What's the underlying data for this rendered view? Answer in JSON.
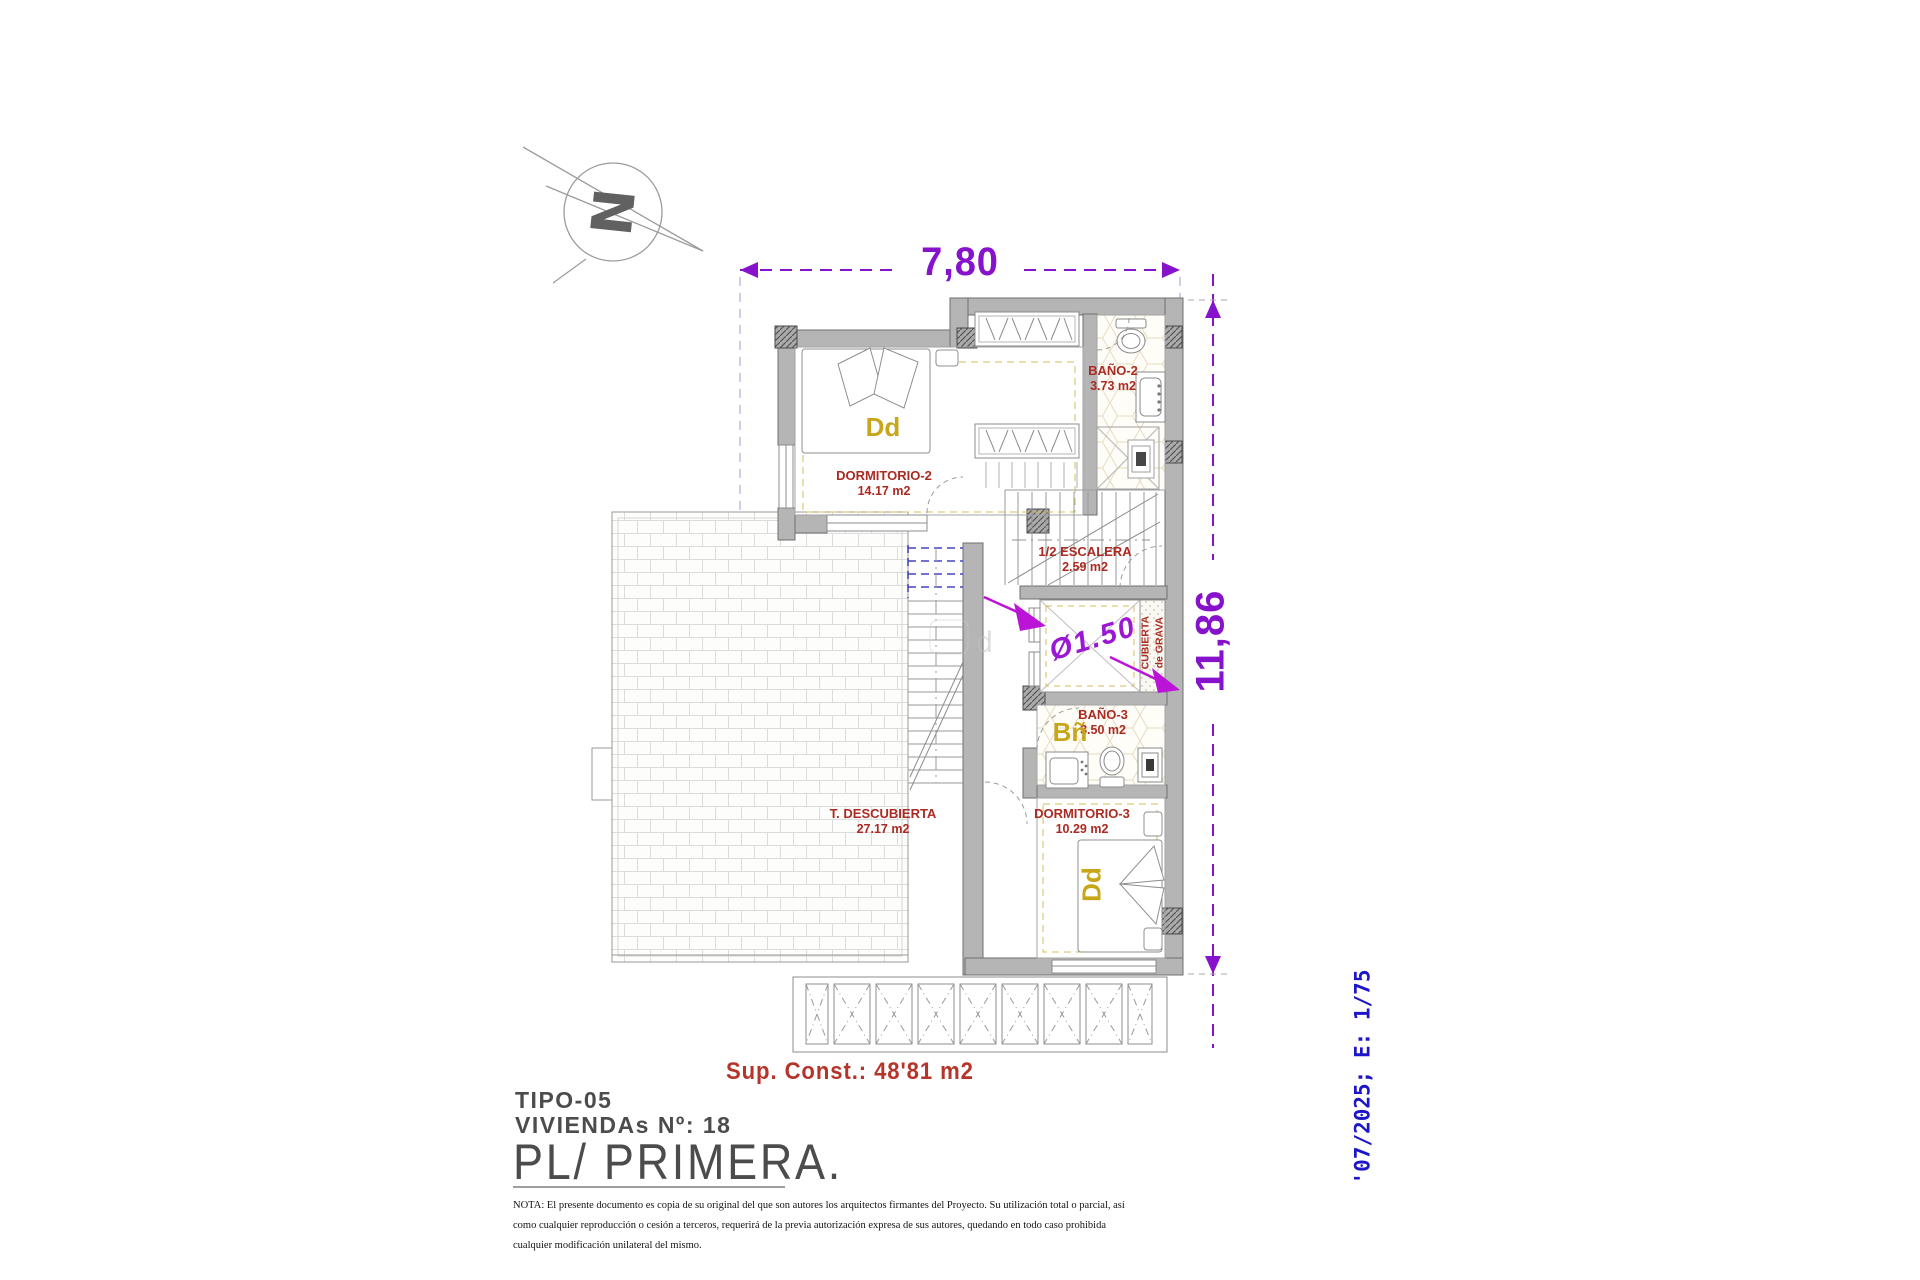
{
  "dimensions": {
    "width_label": "7,80",
    "height_label": "11,86",
    "diameter_label": "Ø1.50"
  },
  "rooms": {
    "dormitorio2": {
      "name": "DORMITORIO-2",
      "area": "14.17 m2"
    },
    "bano2": {
      "name": "BAÑO-2",
      "area": "3.73 m2"
    },
    "escalera": {
      "name": "1/2 ESCALERA",
      "area": "2.59 m2"
    },
    "bano3": {
      "name": "BAÑO-3",
      "area": "3.50 m2"
    },
    "dormitorio3": {
      "name": "DORMITORIO-3",
      "area": "10.29 m2"
    },
    "terraza": {
      "name": "T. DESCUBIERTA",
      "area": "27.17 m2"
    }
  },
  "furniture_labels": {
    "bed2": "Dd",
    "bed3": "Dd",
    "bath3": "Bñ"
  },
  "annotations": {
    "north_letter": "N",
    "cubierta_line1": "CUBIERTA",
    "cubierta_line2": "de GRAVA",
    "sup_const": "Sup. Const.: 48'81 m2",
    "watermark": "d"
  },
  "title_block": {
    "tipo": "TIPO-05",
    "viviendas": "VIVIENDAs Nº: 18",
    "plan": "PL/ PRIMERA.",
    "note_lines": [
      "NOTA: El presente documento es copia de su original del que son autores los arquitectos firmantes del Proyecto. Su utilización total o parcial, así",
      "como cualquier reproducción o cesión a terceros, requerirá  de la previa autorización expresa de sus autores, quedando en todo caso prohibida",
      "cualquier modificación unilateral del mismo."
    ]
  },
  "side_label": {
    "date_scale": "'07/2025; E: 1/75"
  },
  "colors": {
    "dimension_purple": "#8612cb",
    "arrow_magenta": "#bb14d6",
    "room_label_red": "#ab2a22",
    "furniture_yellow": "#c8a61a",
    "stair_blue": "#4743c0",
    "date_blue": "#1d16c9",
    "wall_gray": "#b5b5b5"
  }
}
